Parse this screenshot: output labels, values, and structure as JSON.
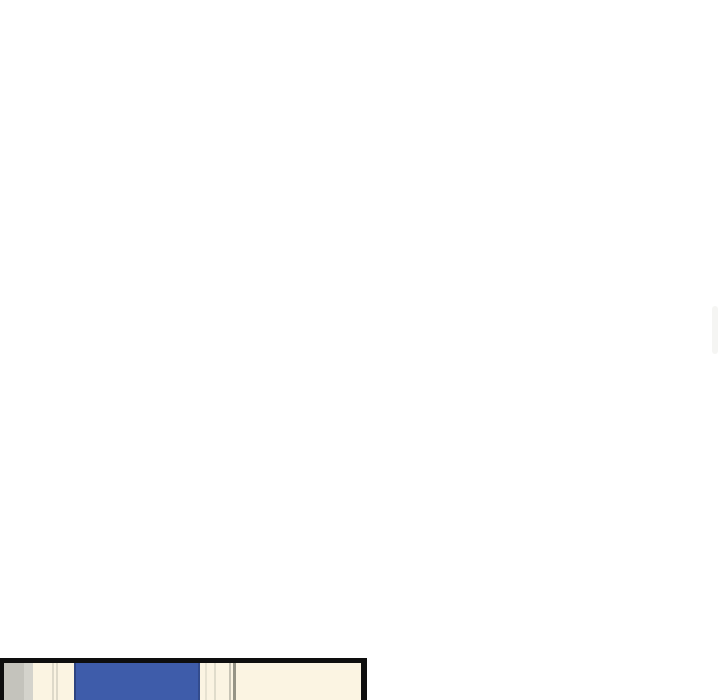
{
  "page": {
    "background": "#ffffff"
  },
  "scrollbar": {
    "thumb_color": "#f5f5f3"
  },
  "comic_panel": {
    "border_color": "#0e0e0e",
    "colors": {
      "wall_gray": "#c4c3bc",
      "wall_gray_light": "#d7d6cf",
      "wall_cream": "#fbf4e2",
      "door_blue": "#3e5caa",
      "door_blue_edge": "#2e4480",
      "seam_faint": "#dad6c6",
      "seam_mid": "#c1beaf",
      "seam_dark": "#8b897c"
    }
  }
}
